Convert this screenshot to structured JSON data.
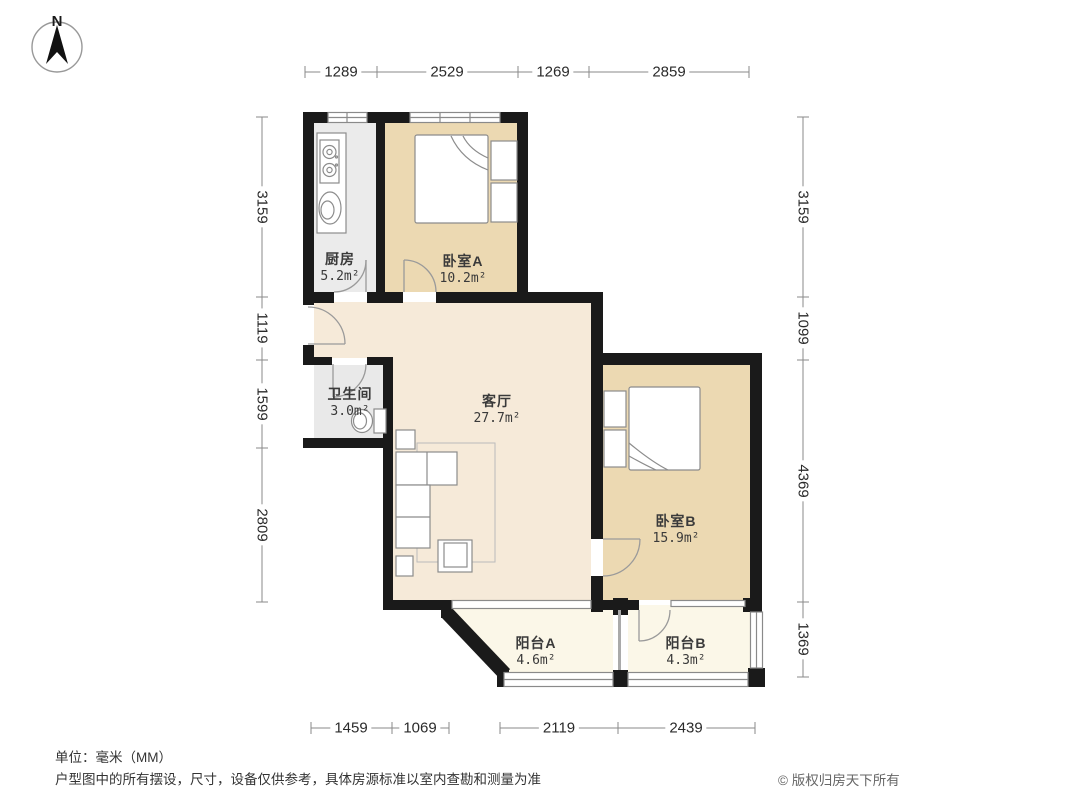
{
  "meta": {
    "compass_label": "N",
    "unit_note": "单位：毫米（MM）",
    "disclaimer": "户型图中的所有摆设，尺寸，设备仅供参考，具体房源标准以室内查勘和测量为准",
    "copyright": "© 版权归房天下所有"
  },
  "colors": {
    "wall": "#1a1a1a",
    "bedroom_fill": "#ecd9b2",
    "living_fill": "#f6ead9",
    "balcony_fill": "#fbf7e8",
    "service_fill": "#ebebeb",
    "line_gray": "#8a8a8a"
  },
  "rooms": {
    "kitchen": {
      "name": "厨房",
      "area": "5.2m²"
    },
    "bedroom_a": {
      "name": "卧室A",
      "area": "10.2m²"
    },
    "bathroom": {
      "name": "卫生间",
      "area": "3.0m²"
    },
    "living": {
      "name": "客厅",
      "area": "27.7m²"
    },
    "bedroom_b": {
      "name": "卧室B",
      "area": "15.9m²"
    },
    "balcony_a": {
      "name": "阳台A",
      "area": "4.6m²"
    },
    "balcony_b": {
      "name": "阳台B",
      "area": "4.3m²"
    }
  },
  "dimensions": {
    "top": [
      "1289",
      "2529",
      "1269",
      "2859"
    ],
    "left": [
      "3159",
      "1119",
      "1599",
      "2809"
    ],
    "right": [
      "3159",
      "1099",
      "4369",
      "1369"
    ],
    "bottom": [
      "1459",
      "1069",
      "2119",
      "2439"
    ]
  }
}
